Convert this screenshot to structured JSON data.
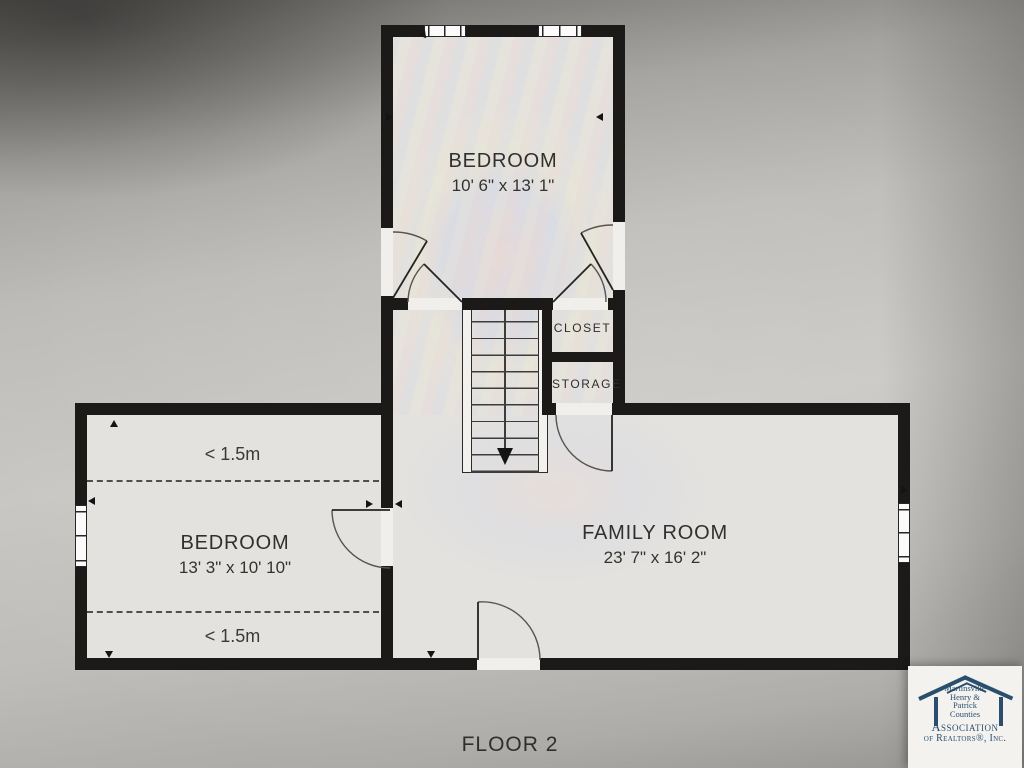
{
  "floor_plan": {
    "floor_label": "FLOOR 2",
    "rooms": {
      "bedroom_top": {
        "name": "BEDROOM",
        "dims": "10' 6\" x 13' 1\""
      },
      "bedroom_left": {
        "name": "BEDROOM",
        "dims": "13' 3\" x 10' 10\""
      },
      "family_room": {
        "name": "FAMILY ROOM",
        "dims": "23' 7\" x 16' 2\""
      },
      "closet": {
        "name": "CLOSET"
      },
      "storage": {
        "name": "STORAGE"
      }
    },
    "annotations": {
      "low_ceiling_top": "< 1.5m",
      "low_ceiling_bottom": "< 1.5m"
    },
    "stairs": {
      "direction": "down"
    }
  },
  "logo": {
    "location_lines": [
      "Martinsville",
      "Henry &",
      "Patrick",
      "Counties"
    ],
    "org_line1": "Association",
    "org_line2": "of Realtors®, Inc."
  },
  "colors": {
    "wall": "#1b1a18",
    "floor": "#e4e2de",
    "photo_background": "#b5b3af",
    "logo_navy": "#2a4f6e",
    "text": "#2b2b28"
  }
}
